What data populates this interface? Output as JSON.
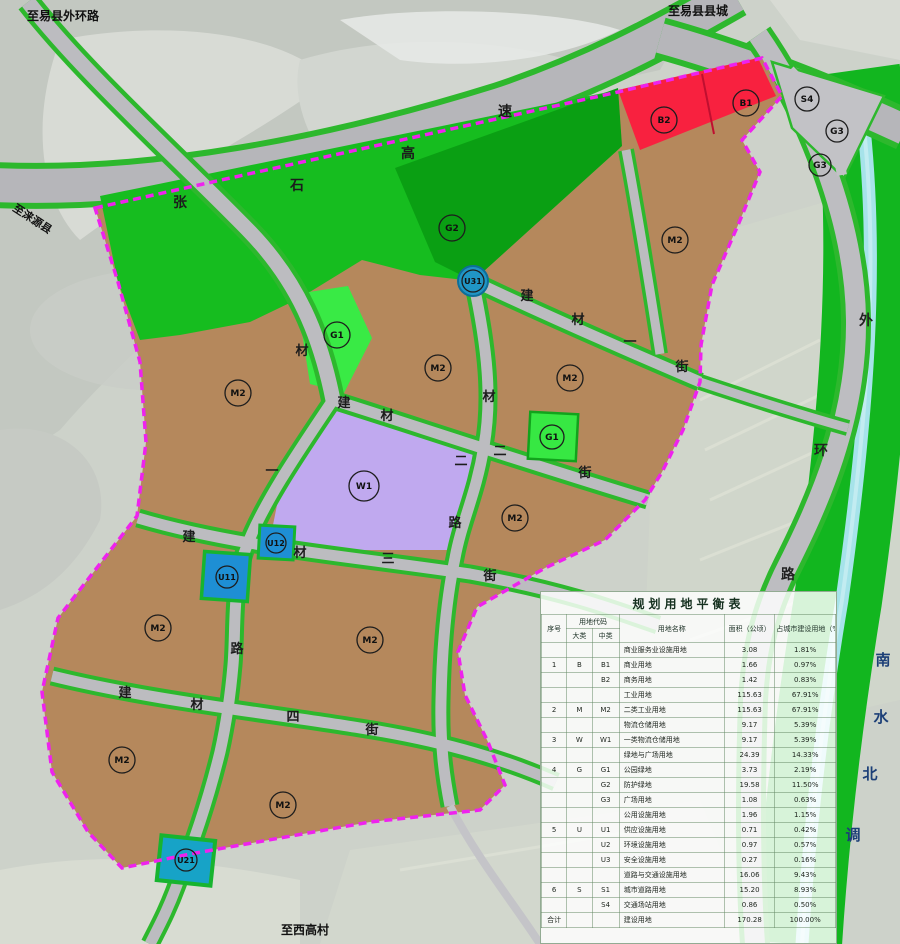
{
  "page_title": "规划用地平衡表",
  "colors": {
    "industrial_brown": "#b5885c",
    "logistics_purple": "#c0a9ef",
    "commercial_red": "#f8213f",
    "park_green": "#39ea45",
    "buffer_green": "#16bd1f",
    "buffer_green_dark": "#0a9f13",
    "road_casing_green": "#2db82d",
    "road_gray": "#bcbcc0",
    "boundary_magenta": "#ee22ee",
    "utility_blue": "#1e8fd4",
    "utility_teal": "#17a3c7",
    "canal_cyan": "#a6e3ea",
    "corridor_green": "#12b61f",
    "satellite_gray": "#cdd2ca"
  },
  "map": {
    "edge_labels": [
      {
        "text": "至易县外环路",
        "x": 27,
        "y": 20,
        "size": 12,
        "rotate": 0
      },
      {
        "text": "至易县县城",
        "x": 668,
        "y": 15,
        "size": 12,
        "rotate": 0
      },
      {
        "text": "至涞源县",
        "x": 12,
        "y": 210,
        "size": 11,
        "rotate": 33
      },
      {
        "text": "至西高村",
        "x": 281,
        "y": 934,
        "size": 12,
        "rotate": 0
      }
    ],
    "road_chars": [
      {
        "ch": "张",
        "x": 180,
        "y": 207,
        "size": 14,
        "color": "#1c1c1c"
      },
      {
        "ch": "石",
        "x": 297,
        "y": 190,
        "size": 14,
        "color": "#1c1c1c"
      },
      {
        "ch": "高",
        "x": 408,
        "y": 158,
        "size": 14,
        "color": "#1c1c1c"
      },
      {
        "ch": "速",
        "x": 505,
        "y": 116,
        "size": 14,
        "color": "#1c1c1c"
      },
      {
        "ch": "建",
        "x": 527,
        "y": 300,
        "size": 13,
        "color": "#1c1c1c"
      },
      {
        "ch": "材",
        "x": 578,
        "y": 324,
        "size": 13,
        "color": "#1c1c1c"
      },
      {
        "ch": "一",
        "x": 630,
        "y": 346,
        "size": 13,
        "color": "#1c1c1c"
      },
      {
        "ch": "街",
        "x": 682,
        "y": 371,
        "size": 13,
        "color": "#1c1c1c"
      },
      {
        "ch": "建",
        "x": 344,
        "y": 407,
        "size": 13,
        "color": "#1c1c1c"
      },
      {
        "ch": "材",
        "x": 387,
        "y": 420,
        "size": 13,
        "color": "#1c1c1c"
      },
      {
        "ch": "二",
        "x": 500,
        "y": 455,
        "size": 13,
        "color": "#1c1c1c"
      },
      {
        "ch": "街",
        "x": 585,
        "y": 477,
        "size": 13,
        "color": "#1c1c1c"
      },
      {
        "ch": "材",
        "x": 489,
        "y": 401,
        "size": 13,
        "color": "#1c1c1c"
      },
      {
        "ch": "二",
        "x": 461,
        "y": 465,
        "size": 13,
        "color": "#1c1c1c"
      },
      {
        "ch": "路",
        "x": 455,
        "y": 527,
        "size": 13,
        "color": "#1c1c1c"
      },
      {
        "ch": "建",
        "x": 189,
        "y": 541,
        "size": 13,
        "color": "#1c1c1c"
      },
      {
        "ch": "材",
        "x": 300,
        "y": 557,
        "size": 13,
        "color": "#1c1c1c"
      },
      {
        "ch": "三",
        "x": 388,
        "y": 563,
        "size": 13,
        "color": "#1c1c1c"
      },
      {
        "ch": "街",
        "x": 490,
        "y": 580,
        "size": 13,
        "color": "#1c1c1c"
      },
      {
        "ch": "建",
        "x": 125,
        "y": 697,
        "size": 13,
        "color": "#1c1c1c"
      },
      {
        "ch": "材",
        "x": 197,
        "y": 709,
        "size": 13,
        "color": "#1c1c1c"
      },
      {
        "ch": "四",
        "x": 293,
        "y": 721,
        "size": 13,
        "color": "#1c1c1c"
      },
      {
        "ch": "街",
        "x": 372,
        "y": 734,
        "size": 13,
        "color": "#1c1c1c"
      },
      {
        "ch": "材",
        "x": 302,
        "y": 355,
        "size": 13,
        "color": "#1c1c1c"
      },
      {
        "ch": "一",
        "x": 272,
        "y": 475,
        "size": 13,
        "color": "#1c1c1c"
      },
      {
        "ch": "路",
        "x": 237,
        "y": 653,
        "size": 13,
        "color": "#1c1c1c"
      },
      {
        "ch": "外",
        "x": 866,
        "y": 325,
        "size": 14,
        "color": "#222222"
      },
      {
        "ch": "环",
        "x": 821,
        "y": 455,
        "size": 14,
        "color": "#222222"
      },
      {
        "ch": "路",
        "x": 788,
        "y": 579,
        "size": 14,
        "color": "#222222"
      },
      {
        "ch": "南",
        "x": 883,
        "y": 665,
        "size": 15,
        "color": "#1c3f77"
      },
      {
        "ch": "水",
        "x": 881,
        "y": 722,
        "size": 15,
        "color": "#1c3f77"
      },
      {
        "ch": "北",
        "x": 870,
        "y": 779,
        "size": 15,
        "color": "#1c3f77"
      },
      {
        "ch": "调",
        "x": 853,
        "y": 840,
        "size": 15,
        "color": "#1c3f77"
      }
    ],
    "zone_badges": [
      {
        "label": "G2",
        "x": 452,
        "y": 228,
        "r": 13
      },
      {
        "label": "B2",
        "x": 664,
        "y": 120,
        "r": 13
      },
      {
        "label": "B1",
        "x": 746,
        "y": 103,
        "r": 13
      },
      {
        "label": "S4",
        "x": 807,
        "y": 99,
        "r": 12
      },
      {
        "label": "G3",
        "x": 837,
        "y": 131,
        "r": 11
      },
      {
        "label": "G3",
        "x": 820,
        "y": 165,
        "r": 11
      },
      {
        "label": "M2",
        "x": 675,
        "y": 240,
        "r": 13
      },
      {
        "label": "M2",
        "x": 238,
        "y": 393,
        "r": 13
      },
      {
        "label": "M2",
        "x": 438,
        "y": 368,
        "r": 13
      },
      {
        "label": "M2",
        "x": 570,
        "y": 378,
        "r": 13
      },
      {
        "label": "M2",
        "x": 515,
        "y": 518,
        "r": 13
      },
      {
        "label": "M2",
        "x": 158,
        "y": 628,
        "r": 13
      },
      {
        "label": "M2",
        "x": 370,
        "y": 640,
        "r": 13
      },
      {
        "label": "M2",
        "x": 122,
        "y": 760,
        "r": 13
      },
      {
        "label": "M2",
        "x": 283,
        "y": 805,
        "r": 13
      },
      {
        "label": "W1",
        "x": 364,
        "y": 486,
        "r": 15
      },
      {
        "label": "G1",
        "x": 337,
        "y": 335,
        "r": 13
      },
      {
        "label": "G1",
        "x": 552,
        "y": 437,
        "r": 12
      },
      {
        "label": "U31",
        "x": 473,
        "y": 281,
        "r": 11
      },
      {
        "label": "U12",
        "x": 276,
        "y": 543,
        "r": 10
      },
      {
        "label": "U11",
        "x": 227,
        "y": 577,
        "r": 11
      },
      {
        "label": "U21",
        "x": 186,
        "y": 860,
        "r": 11
      }
    ]
  },
  "table": {
    "title": "规划用地平衡表",
    "headers": {
      "seq": "序号",
      "code": "用地代码",
      "major": "大类",
      "minor": "中类",
      "name": "用地名称",
      "area": "面积（公顷）",
      "pct": "占城市建设用地（%）"
    },
    "rows": [
      [
        "",
        "",
        "",
        "商业服务业设施用地",
        "3.08",
        "1.81%"
      ],
      [
        "1",
        "B",
        "B1",
        "商业用地",
        "1.66",
        "0.97%"
      ],
      [
        "",
        "",
        "B2",
        "商务用地",
        "1.42",
        "0.83%"
      ],
      [
        "",
        "",
        "",
        "工业用地",
        "115.63",
        "67.91%"
      ],
      [
        "2",
        "M",
        "M2",
        "二类工业用地",
        "115.63",
        "67.91%"
      ],
      [
        "",
        "",
        "",
        "物流仓储用地",
        "9.17",
        "5.39%"
      ],
      [
        "3",
        "W",
        "W1",
        "一类物流仓储用地",
        "9.17",
        "5.39%"
      ],
      [
        "",
        "",
        "",
        "绿地与广场用地",
        "24.39",
        "14.33%"
      ],
      [
        "4",
        "G",
        "G1",
        "公园绿地",
        "3.73",
        "2.19%"
      ],
      [
        "",
        "",
        "G2",
        "防护绿地",
        "19.58",
        "11.50%"
      ],
      [
        "",
        "",
        "G3",
        "广场用地",
        "1.08",
        "0.63%"
      ],
      [
        "",
        "",
        "",
        "公用设施用地",
        "1.96",
        "1.15%"
      ],
      [
        "5",
        "U",
        "U1",
        "供应设施用地",
        "0.71",
        "0.42%"
      ],
      [
        "",
        "",
        "U2",
        "环境设施用地",
        "0.97",
        "0.57%"
      ],
      [
        "",
        "",
        "U3",
        "安全设施用地",
        "0.27",
        "0.16%"
      ],
      [
        "",
        "",
        "",
        "道路与交通设施用地",
        "16.06",
        "9.43%"
      ],
      [
        "6",
        "S",
        "S1",
        "城市道路用地",
        "15.20",
        "8.93%"
      ],
      [
        "",
        "",
        "S4",
        "交通场站用地",
        "0.86",
        "0.50%"
      ],
      [
        "合计",
        "",
        "",
        "建设用地",
        "170.28",
        "100.00%"
      ]
    ]
  }
}
